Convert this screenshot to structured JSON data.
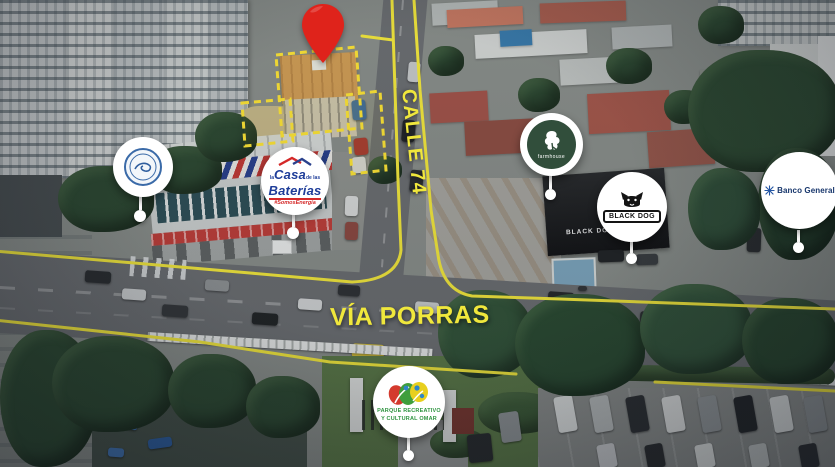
{
  "scene": {
    "description": "Aerial drone view of the Via Porras and Calle 74 intersection with a highlighted property, red location pin and nearby business badges"
  },
  "streets": {
    "calle_74": "CALLE 74",
    "via_porras": "VÍA PORRAS"
  },
  "badges": {
    "casa_baterias": {
      "prefix": "la",
      "word1": "Casa",
      "connector": "de las",
      "word2": "Baterías",
      "tagline": "#SomosEnergía"
    },
    "farmhouse": {
      "label": "farmhouse"
    },
    "black_dog": {
      "label": "BLACK DOG"
    },
    "banco_general": {
      "label": "Banco General"
    },
    "parque_omar": {
      "line1": "PARQUE RECREATIVO",
      "line2": "Y CULTURAL OMAR"
    }
  },
  "signs": {
    "black_dog_storefront": "BLACK DOG"
  },
  "colors": {
    "route_highlight": "#f5ea3d",
    "pin_red": "#df231b",
    "badge_background": "#ffffff",
    "casa_blue": "#1e3d99",
    "casa_red": "#d42828",
    "farmhouse_green": "#314e3b",
    "banco_blue": "#16356b",
    "parque_green": "#2f9440"
  }
}
